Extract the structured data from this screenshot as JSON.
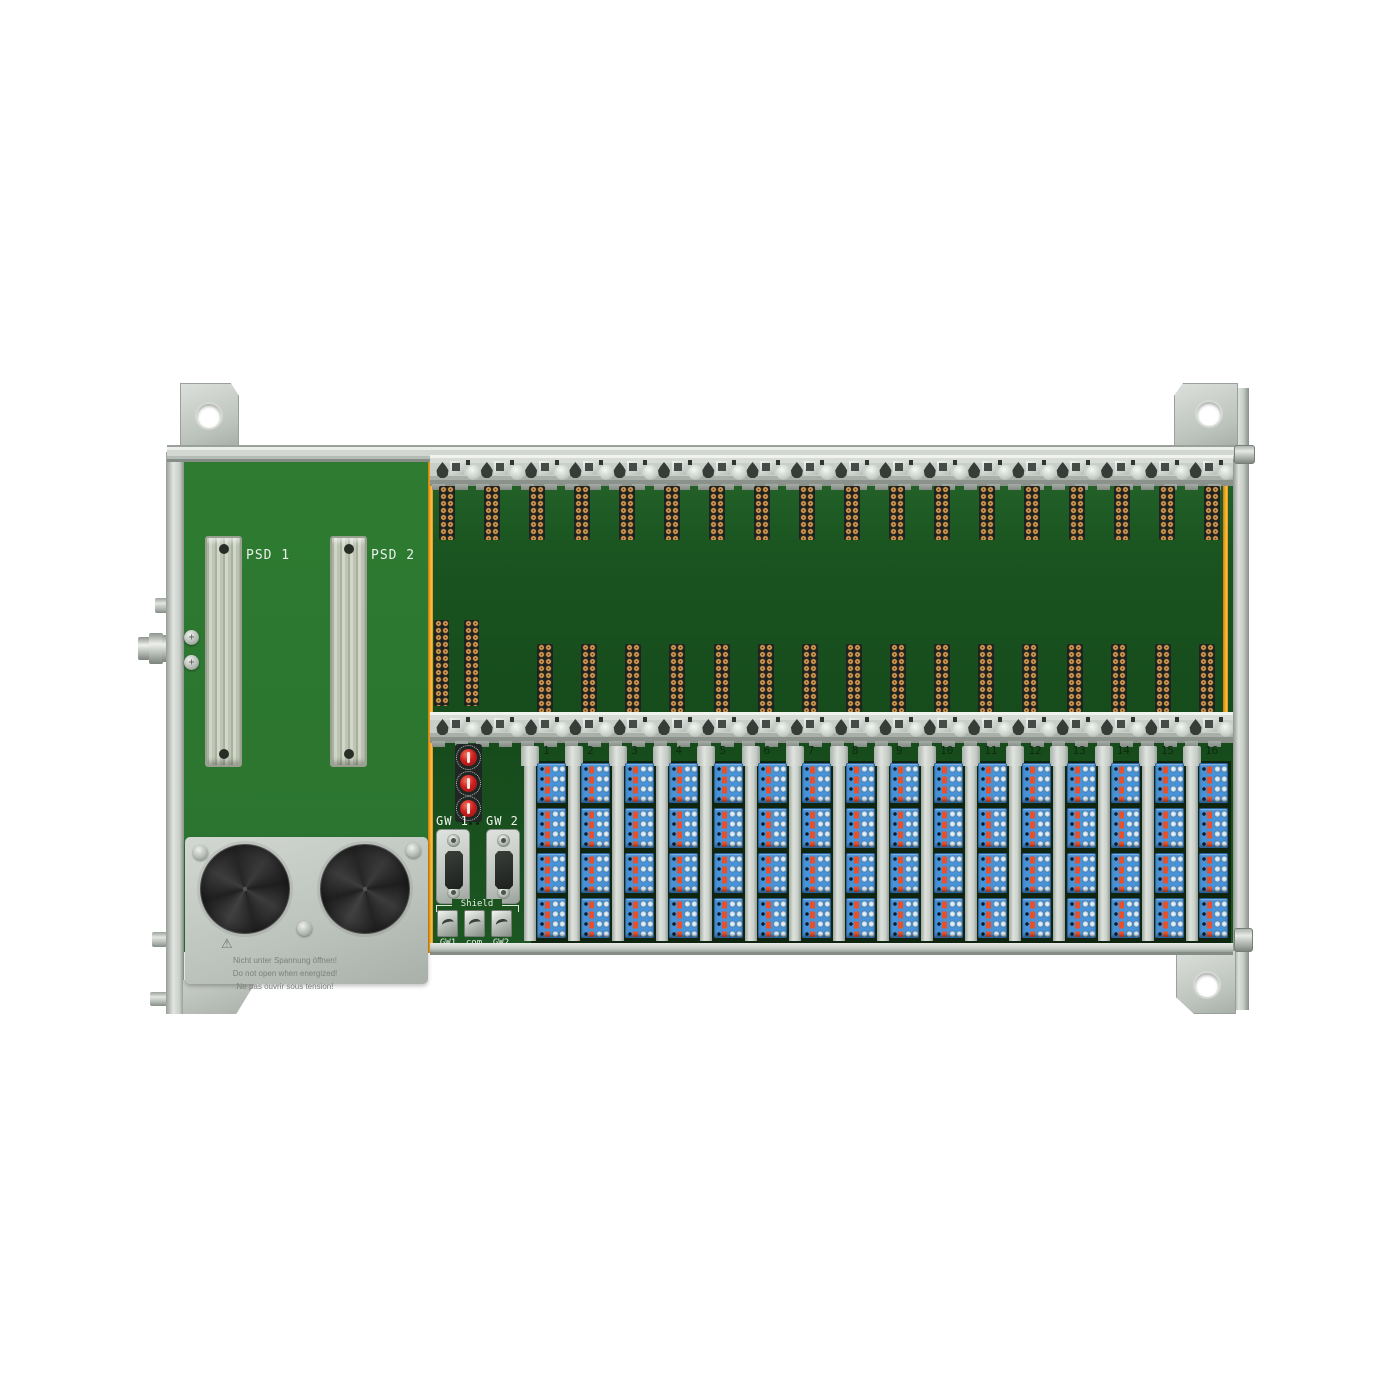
{
  "device": {
    "labels": {
      "psd1": "PSD 1",
      "psd2": "PSD 2",
      "gw1": "GW 1",
      "gw2": "GW 2",
      "shield": "Shield",
      "shield_terminals": [
        "GW1",
        "com",
        "GW2"
      ]
    },
    "warning": {
      "symbol": "⚠",
      "de": "Nicht unter Spannung öffnen!",
      "en": "Do not open when energized!",
      "fr": "Ne pas ouvrir sous tension!"
    },
    "channels": [
      "1",
      "2",
      "3",
      "4",
      "5",
      "6",
      "7",
      "8",
      "9",
      "10",
      "11",
      "12",
      "13",
      "14",
      "15",
      "16"
    ],
    "counts": {
      "din_rails": 2,
      "clips_per_rail": 18,
      "top_pad_columns": 18,
      "mid_pad_columns": 16,
      "aux_pad_columns": 2,
      "terminal_columns": 16,
      "terminal_blocks_per_column": 4,
      "terminal_rows_per_block": 4,
      "rotary_switches": 3,
      "dsub_connectors": 2,
      "vent_discs": 2
    },
    "colors": {
      "pcb_left": "#2e7b31",
      "pcb_right": "#1d5722",
      "edge_orange": "#f2a41c",
      "terminal_blue": "#4792d8",
      "lever_red": "#e8502b",
      "rotary_red": "#cc1f1f",
      "gold_pad": "#cf9a55"
    }
  }
}
